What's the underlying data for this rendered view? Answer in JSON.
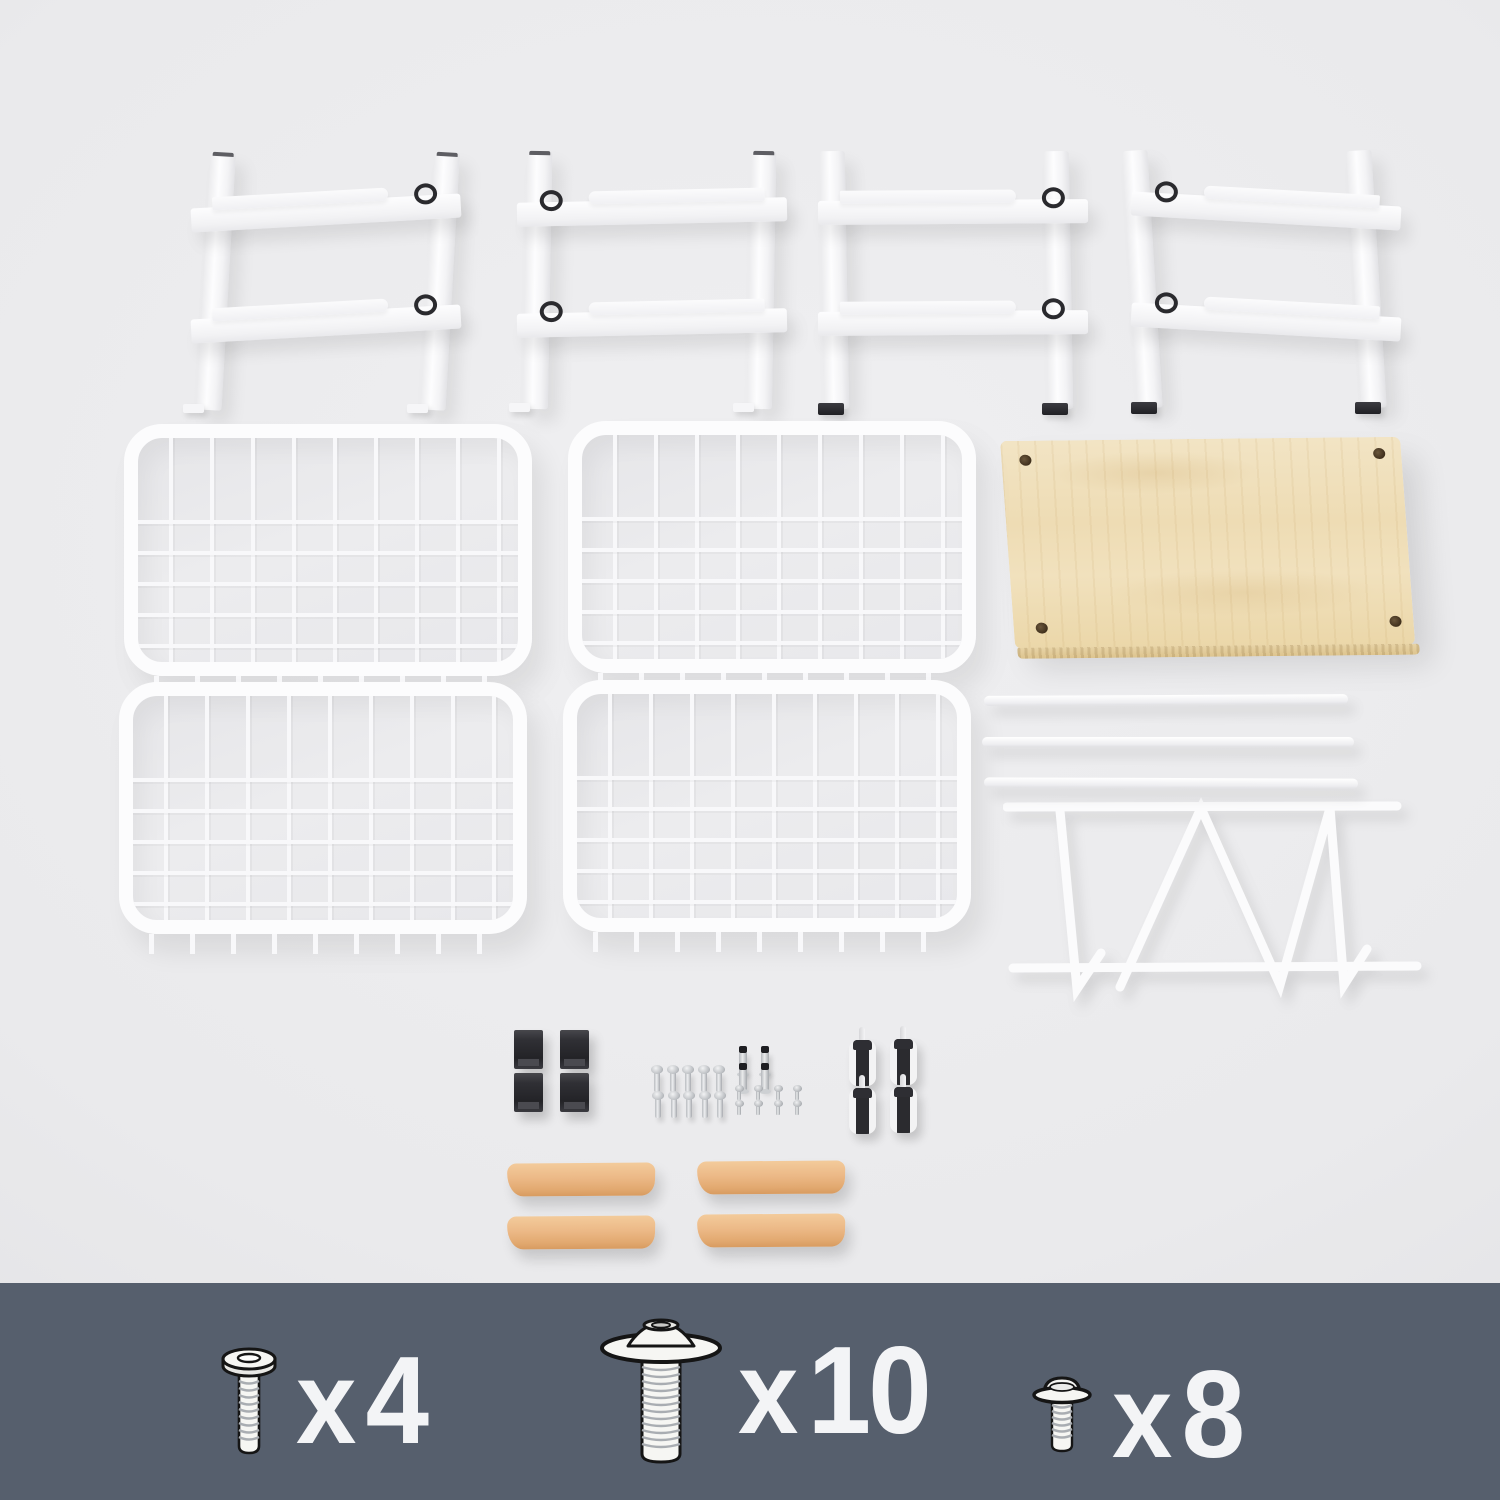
{
  "scene": {
    "background_color": "#eaeaec",
    "legend_background_color": "#565f6d",
    "legend_text_color": "#f3f4f6"
  },
  "parts": {
    "side_frame": {
      "count": 4
    },
    "wire_basket": {
      "count": 4
    },
    "wood_top_board": {
      "count": 1
    },
    "support_rail": {
      "count": 3
    },
    "wire_divider_rack": {
      "count": 1
    },
    "black_foot_cap": {
      "count": 4
    },
    "caster_wheel": {
      "count": 4
    },
    "wood_handle": {
      "count": 4
    },
    "machine_screw_loose": {
      "count": 10
    },
    "stud_bolt_loose": {
      "count": 4
    },
    "small_screw_loose": {
      "count": 8
    }
  },
  "legend": {
    "items": [
      {
        "icon": "pan-head-screw-icon",
        "prefix": "x",
        "count": "4"
      },
      {
        "icon": "flange-bolt-icon",
        "prefix": "x",
        "count": "10"
      },
      {
        "icon": "small-flange-screw-icon",
        "prefix": "x",
        "count": "8"
      }
    ]
  }
}
